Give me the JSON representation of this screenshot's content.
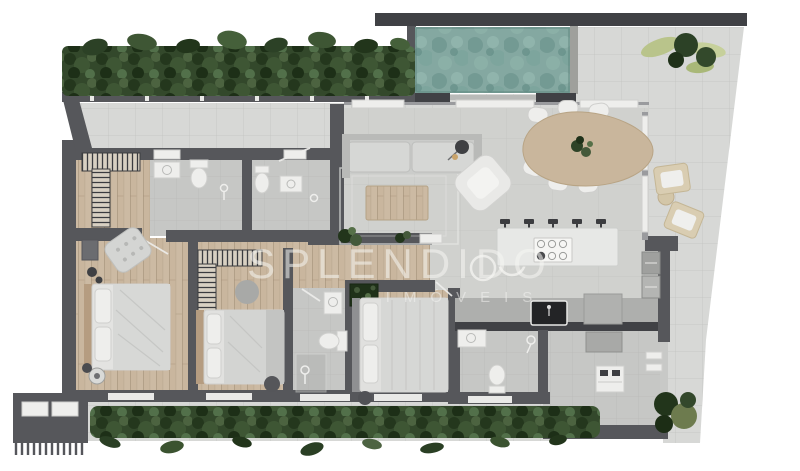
{
  "watermark": {
    "title": "SPLENDIDO",
    "subtitle": "IMÓVEIS"
  },
  "palette": {
    "wall": "#56575b",
    "wall_dark": "#404145",
    "wood": "#c9b69e",
    "wood_table": "#c9b69c",
    "tile": "#d7d8d6",
    "floor": "#d0d1ce",
    "bath": "#c6c7c5",
    "pool": "#84a8a1",
    "pool_deep": "#6d948d",
    "plant": "#33482b",
    "plant_dark": "#22351b",
    "plant_light": "#b9c48b",
    "furn_white": "#eeeeec",
    "furn_gray": "#c7c8c6",
    "counter": "#e7e8e6",
    "watermark": "#f5f5f3"
  }
}
